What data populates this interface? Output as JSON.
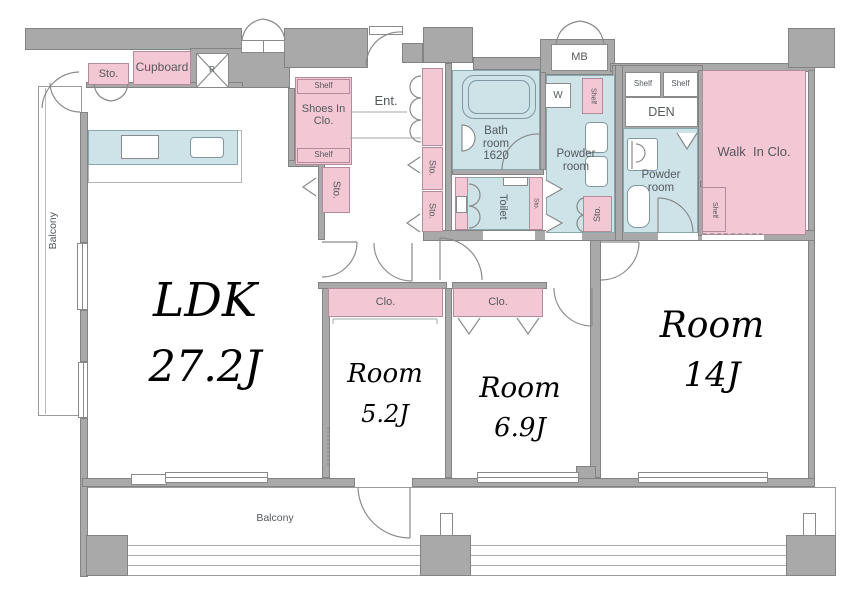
{
  "colors": {
    "pink": "#f3c7d4",
    "pink_border": "#b48b9c",
    "blue": "#cde3e8",
    "blue_border": "#8aa7b0",
    "wall": "#a9a9a9",
    "wall_border": "#838383",
    "label_text": "#54595c",
    "room_text": "#000000"
  },
  "labels": {
    "sto": "Sto.",
    "cupboard": "Cupboard",
    "refrigerator": "R",
    "shelf": "Shelf",
    "shoes_line1": "Shoes In",
    "shoes_line2": "Clo.",
    "entrance": "Ent.",
    "bath_line1": "Bath",
    "bath_line2": "room",
    "bath_line3": "1620",
    "washer": "W",
    "meter_box": "MB",
    "toilet": "Toilet",
    "powder_line1": "Powder",
    "powder_line2": "room",
    "den": "DEN",
    "walk_in_closet": "Walk  In Clo.",
    "closet": "Clo.",
    "balcony": "Balcony"
  },
  "rooms": {
    "ldk": {
      "name": "LDK",
      "size": "27.2J"
    },
    "room_5_2": {
      "name": "Room",
      "size": "5.2J"
    },
    "room_6_9": {
      "name": "Room",
      "size": "6.9J"
    },
    "room_14": {
      "name": "Room",
      "size": "14J"
    }
  }
}
